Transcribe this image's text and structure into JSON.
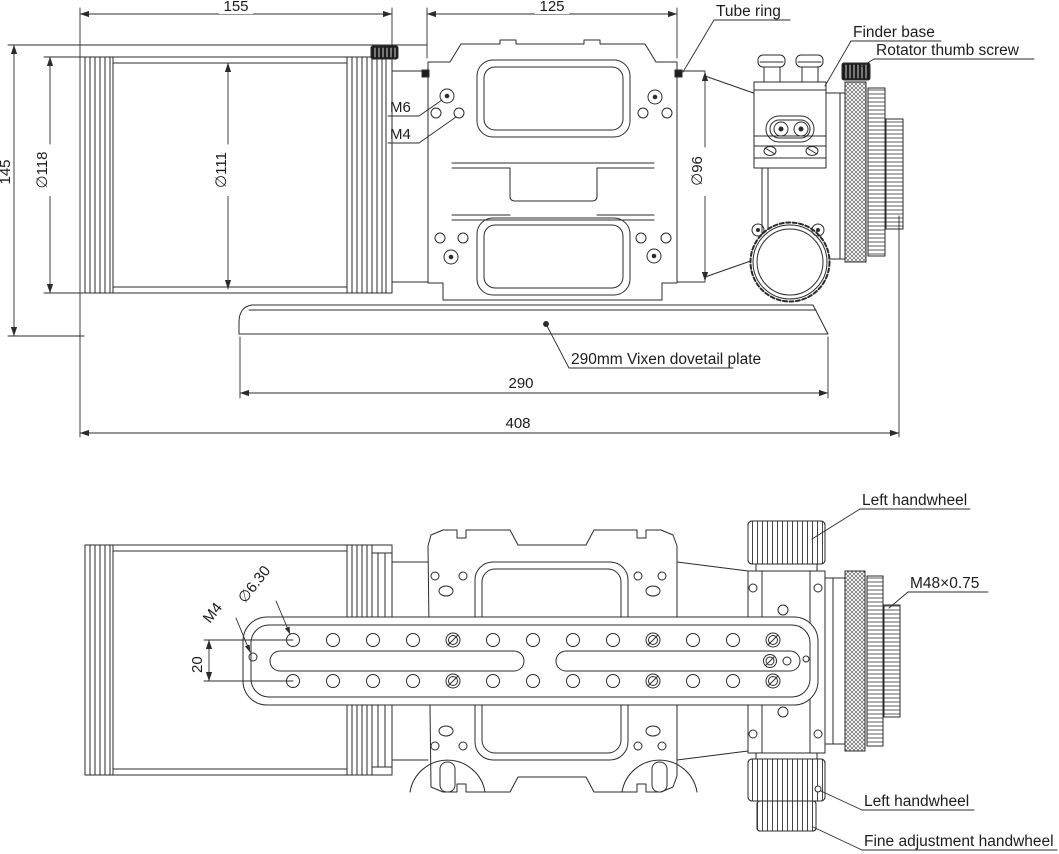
{
  "drawing": {
    "title_hint": "telescope optical tube dimensional drawing",
    "colors": {
      "line": "#2b2b2b",
      "dark_fill": "#1c1c1c",
      "background": "#ffffff"
    },
    "top_view": {
      "dim_155": "155",
      "dim_125": "125",
      "dim_145": "145",
      "dia_118": "∅118",
      "dia_111": "∅111",
      "dia_96": "∅96",
      "m6": "M6",
      "m4": "M4",
      "dim_290": "290",
      "dim_408": "408",
      "label_tube_ring": "Tube ring",
      "label_finder_base": "Finder base",
      "label_rotator_thumb_screw": "Rotator thumb screw",
      "label_dovetail_plate": "290mm Vixen dovetail plate"
    },
    "bottom_view": {
      "label_left_handwheel_top": "Left handwheel",
      "label_m48_thread": "M48×0.75",
      "dia_6_30": "∅6.30",
      "m4": "M4",
      "dim_20": "20",
      "label_left_handwheel_bottom": "Left handwheel",
      "label_fine_adjustment_handwheel": "Fine adjustment handwheel"
    }
  }
}
